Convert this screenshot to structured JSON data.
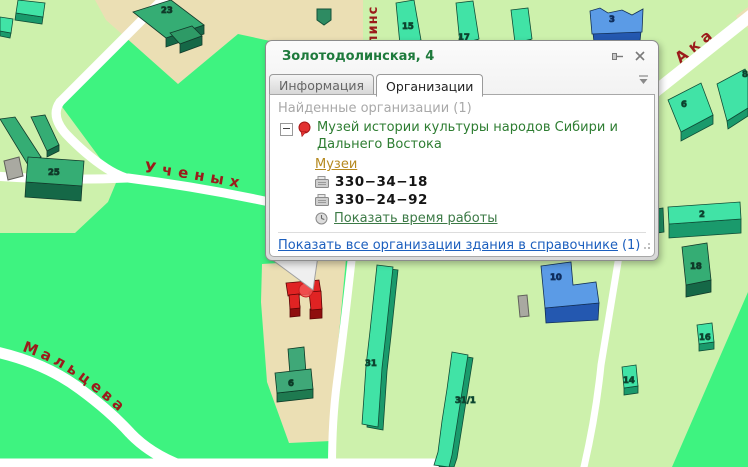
{
  "popup": {
    "title": "Золотодолинская, 4",
    "tabs": {
      "info": "Информация",
      "orgs": "Организации"
    },
    "found_header": "Найденные организации (1)",
    "org": {
      "name": "Музей истории культуры народов Сибири и Дальнего Востока",
      "category": "Музеи",
      "phone1": "330−34−18",
      "phone2": "330−24−92",
      "hours_link": "Показать время работы"
    },
    "footer": {
      "link": "Показать все организации здания в справочнике",
      "count": "(1)"
    }
  },
  "map": {
    "streets": {
      "uchenykh": "Ученых",
      "maltseva": "Мальцева",
      "akademicheskaya_fragment": "Ака",
      "zolotodolinskaya_fragment": "линс"
    },
    "building_labels": {
      "b23": "23",
      "b15": "15",
      "b17": "17",
      "b3": "3",
      "b6r": "6",
      "b8": "8",
      "b2": "2",
      "b18": "18",
      "b16": "16",
      "b14": "14",
      "b10": "10",
      "b25": "25",
      "b31": "31",
      "b31_1": "31/1",
      "b6m": "6"
    }
  },
  "colors": {
    "map_green": "#3EF380",
    "map_pale_green": "#CDF1AC",
    "map_beige": "#EBDFB4",
    "road_white": "#FFFFFF",
    "street_label": "#9B1B1B",
    "building_teal": "#41E3A6",
    "building_teal_dark": "#1A9A6C",
    "building_green": "#35AD74",
    "building_blue": "#5B9BE6",
    "building_red": "#E02323",
    "popup_title_green": "#1E7A3C",
    "org_green": "#2E7D32",
    "category_gold": "#B5891F",
    "link_blue": "#1C5FBE"
  }
}
